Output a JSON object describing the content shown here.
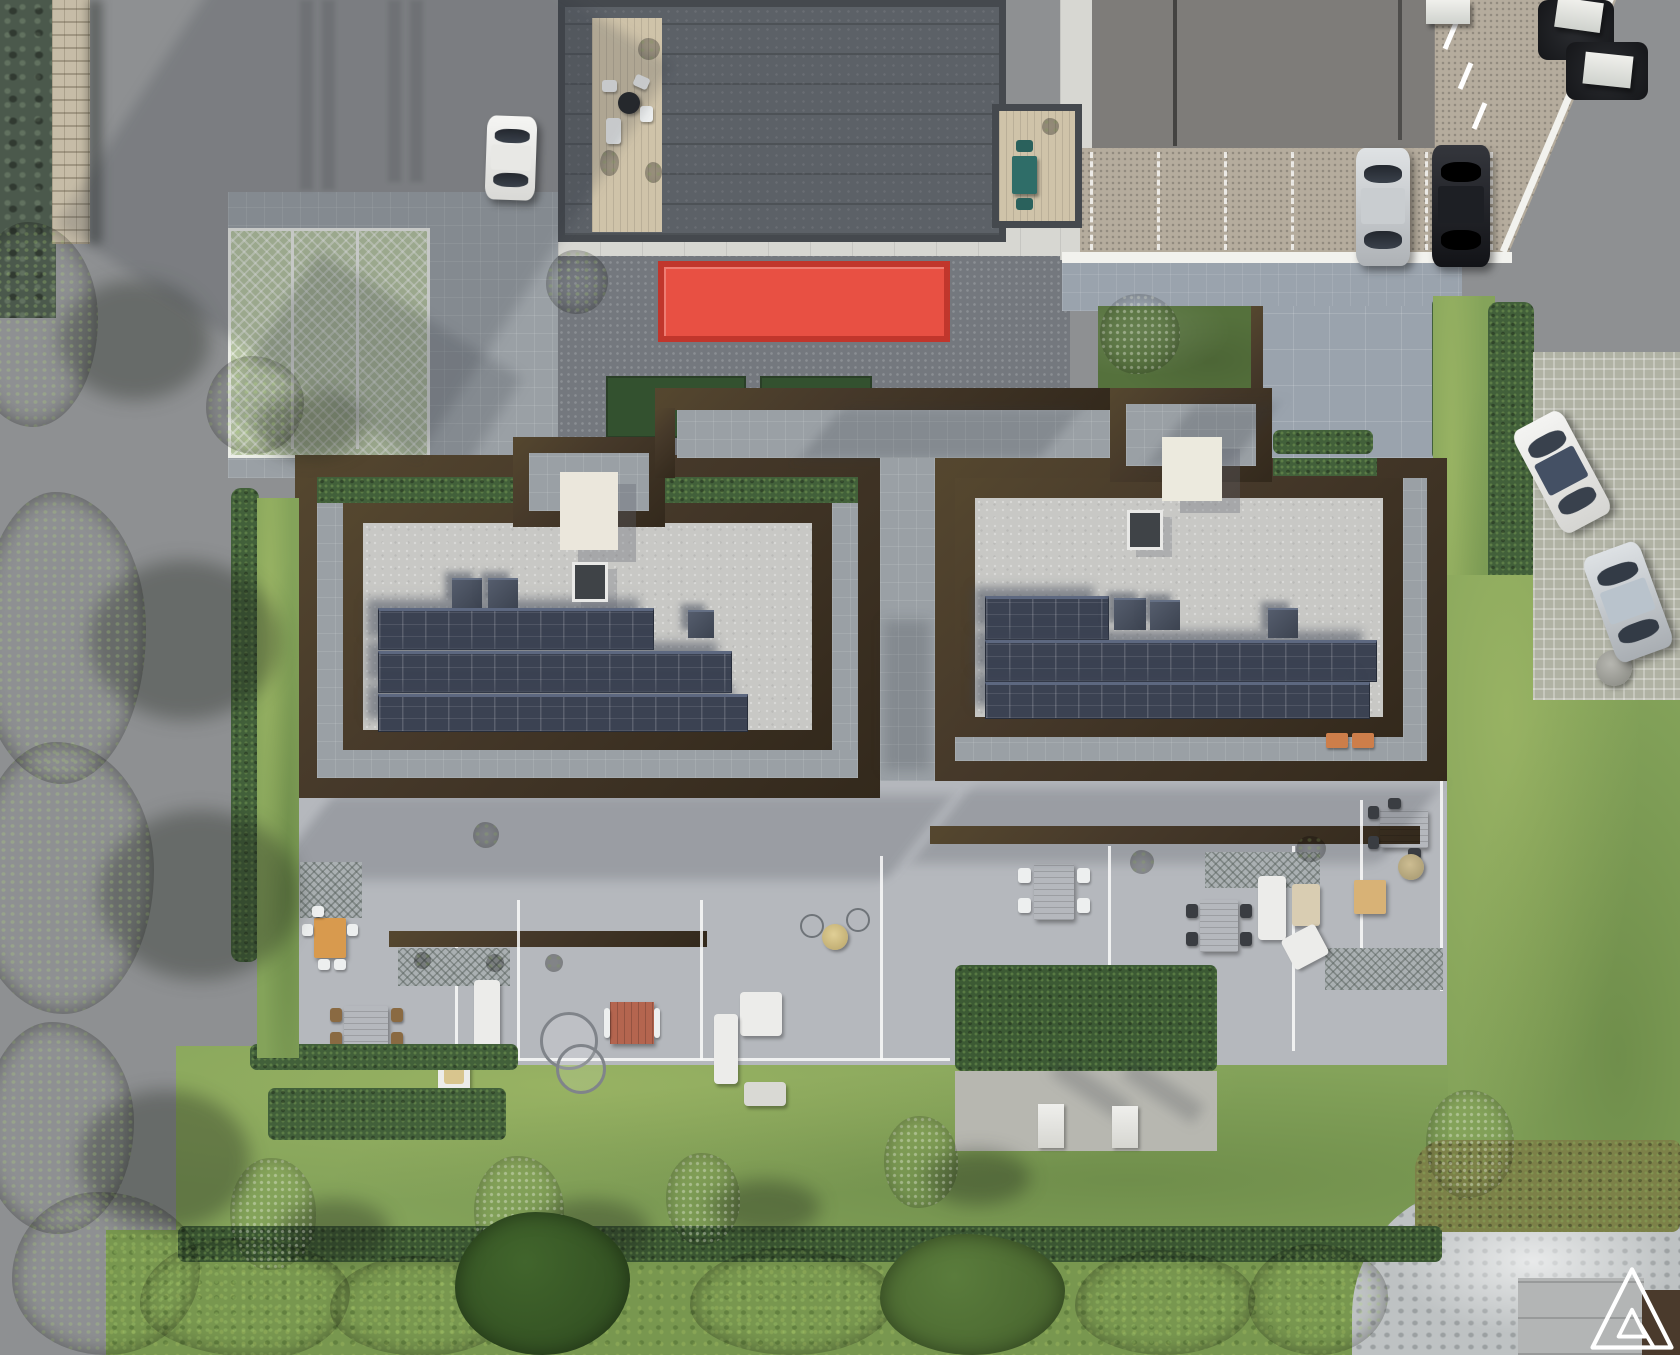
{
  "palette": {
    "asphalt": "#8e9092",
    "asphaltL": "#97999b",
    "plazaDark": "#74787e",
    "paversLight": "#9aa0a5",
    "sidewalk": "#d7d7d2",
    "beige": "#b5ac9d",
    "bluePave": "#9aa3ad",
    "brown": "#46392a",
    "brownD": "#33291c",
    "brownL": "#55472f",
    "gravel": "#c8c8c5",
    "panel": "#3b4252",
    "lawn": "#84a35a",
    "lawnD": "#6e8e4a",
    "meadow": "#78974f",
    "hedge": "#42603a",
    "hedgeD": "#374f31",
    "tree": "#4d6f38",
    "treeD": "#3a5629",
    "olive": "#92a689",
    "oliveD": "#76886f",
    "deck": "#cfc3a9",
    "red": "#e85043",
    "redD": "#c1362c",
    "teal": "#2f6d68",
    "wood": "#bf9a5d",
    "woodD": "#a37e45",
    "whiteF": "#ececea",
    "cream": "#ebe7dc",
    "roofA": "#5c6167",
    "water": "#4b594c",
    "wall": "#c6bca7",
    "gpile": "#bec2c3",
    "gpark": "#b6c5a1",
    "silver": "#c6cacd",
    "black": "#191a1e",
    "orange": "#cd7e4a",
    "brick": "#b4654f",
    "logo": "#ffffff"
  },
  "site": {
    "view": "top-down-aerial-render",
    "main_building": {
      "parapet_color": "#46392a",
      "roof_color": "#c8c8c5",
      "solar_arrays": {
        "left_wing_rows": 3,
        "right_wing_rows": 3,
        "panel_color": "#3b4252"
      },
      "skylights": 2,
      "roof_hatches": 2,
      "roof_cubes": 6
    },
    "north_building": {
      "roof_color": "#5c6167",
      "deck": "wood",
      "terrace_set_color": "#2f6d68"
    },
    "red_canopy": {
      "color": "#e85043"
    },
    "vehicles": [
      {
        "name": "white-car-north",
        "color": "#f2f2f0"
      },
      {
        "name": "silver-car-northeast",
        "color": "#c6cacd"
      },
      {
        "name": "black-car-northeast",
        "color": "#191a1e"
      },
      {
        "name": "white-car-east",
        "color": "#f2f2f0"
      },
      {
        "name": "silver-car-east",
        "color": "#bfc4c8"
      }
    ],
    "parking": {
      "green_paver_stalls": 3,
      "northeast_marked_stalls": 7,
      "east_grass_paver_bays": 2
    },
    "landscape": {
      "street_trees": 5,
      "garden_trees": 4,
      "olive_trees": 3,
      "hedge_color": "#42603a",
      "lawn_color": "#84a35a"
    },
    "terrace_furniture_groups": 11,
    "rooftop_hvac_units": 3,
    "logo": {
      "name": "architect-logo-watermark",
      "color": "#ffffff",
      "shape": "double-triangle-monogram"
    }
  }
}
